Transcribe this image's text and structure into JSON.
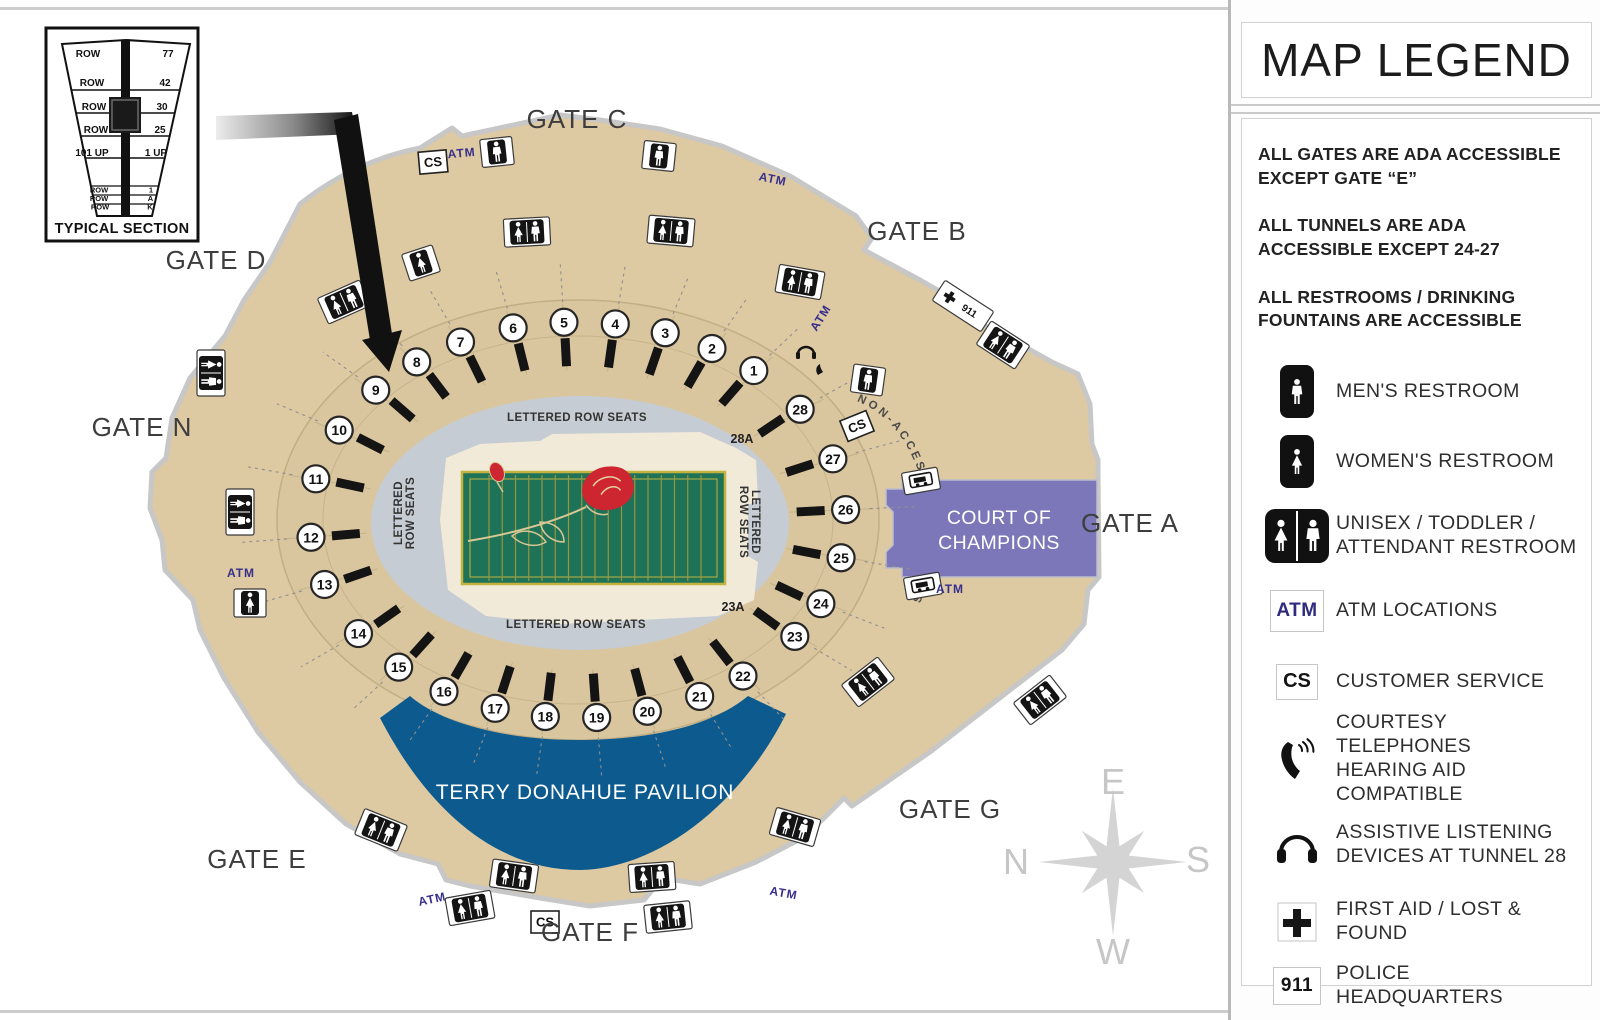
{
  "inset": {
    "title": "TYPICAL SECTION",
    "rows": [
      {
        "label": "ROW",
        "value": "77"
      },
      {
        "label": "ROW",
        "value": "42"
      },
      {
        "label": "ROW",
        "value": "30"
      },
      {
        "label": "ROW",
        "value": "25"
      },
      {
        "label": "101 UP",
        "value": "1 UP"
      },
      {
        "label": "ROW",
        "value": "1"
      },
      {
        "label": "ROW",
        "value": "A"
      },
      {
        "label": "ROW",
        "value": "K"
      }
    ]
  },
  "map": {
    "labels": {
      "lettered_top": "LETTERED ROW SEATS",
      "lettered_bottom": "LETTERED ROW SEATS",
      "lettered_line1": "LETTERED",
      "lettered_line2": "ROW SEATS",
      "sec28a": "28A",
      "sec23a": "23A",
      "non_accessible": "NON-ACCESSIBLE TUNNELS",
      "court_1": "COURT OF",
      "court_2": "CHAMPIONS",
      "pavilion": "TERRY DONAHUE PAVILION"
    },
    "atm_label": "ATM",
    "cs_label": "CS",
    "police_label": "911",
    "gates": [
      {
        "name": "GATE C",
        "x": 577,
        "y": 128
      },
      {
        "name": "GATE B",
        "x": 917,
        "y": 240
      },
      {
        "name": "GATE D",
        "x": 216,
        "y": 269
      },
      {
        "name": "GATE N",
        "x": 142,
        "y": 436
      },
      {
        "name": "GATE A",
        "x": 1130,
        "y": 532
      },
      {
        "name": "GATE G",
        "x": 950,
        "y": 818
      },
      {
        "name": "GATE E",
        "x": 257,
        "y": 868
      },
      {
        "name": "GATE F",
        "x": 590,
        "y": 941
      }
    ],
    "tunnels": [
      {
        "n": "1",
        "a": -49
      },
      {
        "n": "2",
        "a": -60
      },
      {
        "n": "3",
        "a": -71
      },
      {
        "n": "4",
        "a": -82
      },
      {
        "n": "5",
        "a": -93
      },
      {
        "n": "6",
        "a": -104
      },
      {
        "n": "7",
        "a": -116
      },
      {
        "n": "8",
        "a": -127
      },
      {
        "n": "9",
        "a": -139
      },
      {
        "n": "10",
        "a": -153
      },
      {
        "n": "11",
        "a": -168
      },
      {
        "n": "12",
        "a": -185
      },
      {
        "n": "13",
        "a": 161
      },
      {
        "n": "14",
        "a": 145
      },
      {
        "n": "15",
        "a": 132
      },
      {
        "n": "16",
        "a": 120
      },
      {
        "n": "17",
        "a": 108
      },
      {
        "n": "18",
        "a": 97
      },
      {
        "n": "19",
        "a": 86
      },
      {
        "n": "20",
        "a": 75
      },
      {
        "n": "21",
        "a": 63
      },
      {
        "n": "22",
        "a": 52
      },
      {
        "n": "23",
        "a": 36
      },
      {
        "n": "24",
        "a": 25
      },
      {
        "n": "25",
        "a": 11
      },
      {
        "n": "26",
        "a": -3
      },
      {
        "n": "27",
        "a": -18
      },
      {
        "n": "28",
        "a": -34
      }
    ],
    "markers": [
      {
        "type": "men",
        "x": 497,
        "y": 152,
        "rot": -6
      },
      {
        "type": "men",
        "x": 659,
        "y": 156,
        "rot": 6
      },
      {
        "type": "both",
        "x": 527,
        "y": 232,
        "rot": -3
      },
      {
        "type": "both",
        "x": 671,
        "y": 231,
        "rot": 5
      },
      {
        "type": "women",
        "x": 421,
        "y": 263,
        "rot": -18
      },
      {
        "type": "both",
        "x": 344,
        "y": 302,
        "rot": -24
      },
      {
        "type": "both",
        "x": 800,
        "y": 282,
        "rot": 10
      },
      {
        "type": "men",
        "x": 868,
        "y": 380,
        "rot": 8
      },
      {
        "type": "both",
        "x": 211,
        "y": 373,
        "rot": 90
      },
      {
        "type": "both",
        "x": 240,
        "y": 512,
        "rot": 90
      },
      {
        "type": "women",
        "x": 250,
        "y": 603,
        "rot": 0
      },
      {
        "type": "cart",
        "x": 921,
        "y": 481,
        "rot": -10
      },
      {
        "type": "cart",
        "x": 923,
        "y": 586,
        "rot": -10
      },
      {
        "type": "police",
        "x": 963,
        "y": 306,
        "rot": 33
      },
      {
        "type": "both",
        "x": 1003,
        "y": 345,
        "rot": 33
      },
      {
        "type": "both",
        "x": 381,
        "y": 830,
        "rot": 22
      },
      {
        "type": "both",
        "x": 514,
        "y": 876,
        "rot": 8
      },
      {
        "type": "both",
        "x": 652,
        "y": 877,
        "rot": -4
      },
      {
        "type": "both",
        "x": 470,
        "y": 908,
        "rot": -10
      },
      {
        "type": "both",
        "x": 668,
        "y": 917,
        "rot": -6
      },
      {
        "type": "both",
        "x": 795,
        "y": 827,
        "rot": 16
      },
      {
        "type": "both",
        "x": 868,
        "y": 682,
        "rot": -38
      },
      {
        "type": "both",
        "x": 1040,
        "y": 700,
        "rot": -38
      },
      {
        "type": "listen",
        "x": 806,
        "y": 352,
        "rot": 0
      }
    ],
    "atm_positions": [
      {
        "x": 462,
        "y": 157,
        "rot": -5
      },
      {
        "x": 772,
        "y": 183,
        "rot": 12
      },
      {
        "x": 824,
        "y": 320,
        "rot": -58
      },
      {
        "x": 950,
        "y": 593,
        "rot": 0
      },
      {
        "x": 241,
        "y": 577,
        "rot": 0
      },
      {
        "x": 433,
        "y": 903,
        "rot": -12
      },
      {
        "x": 783,
        "y": 897,
        "rot": 10
      }
    ],
    "cs_positions": [
      {
        "x": 433,
        "y": 162,
        "rot": -5
      },
      {
        "x": 857,
        "y": 426,
        "rot": -22
      },
      {
        "x": 545,
        "y": 922,
        "rot": 0
      }
    ],
    "compass": {
      "top": "E",
      "left": "N",
      "right": "S",
      "bottom": "W"
    }
  },
  "legend": {
    "title": "MAP LEGEND",
    "notes": [
      "ALL GATES ARE ADA ACCESSIBLE EXCEPT GATE “E”",
      "ALL TUNNELS ARE ADA ACCESSIBLE EXCEPT 24-27",
      "ALL RESTROOMS / DRINKING FOUNTAINS ARE ACCESSIBLE"
    ],
    "items": [
      {
        "icon": "men-restroom-icon",
        "lines": [
          "MEN'S RESTROOM"
        ],
        "h": 70
      },
      {
        "icon": "women-restroom-icon",
        "lines": [
          "WOMEN'S RESTROOM"
        ],
        "h": 70
      },
      {
        "icon": "unisex-restroom-icon",
        "lines": [
          "UNISEX / TODDLER /",
          "ATTENDANT RESTROOM"
        ],
        "h": 78
      },
      {
        "icon": "atm-icon",
        "lines": [
          "ATM LOCATIONS"
        ],
        "h": 72
      },
      {
        "icon": "customer-service-icon",
        "lines": [
          "CUSTOMER SERVICE"
        ],
        "h": 70
      },
      {
        "icon": "courtesy-phone-icon",
        "lines": [
          "COURTESY TELEPHONES",
          "HEARING AID COMPATIBLE"
        ],
        "h": 84
      },
      {
        "icon": "assistive-listening-icon",
        "lines": [
          "ASSISTIVE LISTENING",
          "DEVICES AT TUNNEL 28"
        ],
        "h": 88
      },
      {
        "icon": "first-aid-icon",
        "lines": [
          "FIRST AID / LOST & FOUND"
        ],
        "h": 66
      },
      {
        "icon": "police-icon",
        "lines": [
          "POLICE HEADQUARTERS"
        ],
        "h": 62
      }
    ]
  },
  "colors": {
    "concourse_tan": "#ddc9a2",
    "bowl_tan": "#dac69e",
    "ring_gray": "#c6ccd3",
    "floor_cream": "#f2ead8",
    "field_green": "#1e7257",
    "field_line": "#97973e",
    "pavilion_blue": "#0d5a8e",
    "court_purple": "#7c77b8",
    "atm_navy": "#372f8c",
    "compass_gray": "#d4d4d4"
  }
}
